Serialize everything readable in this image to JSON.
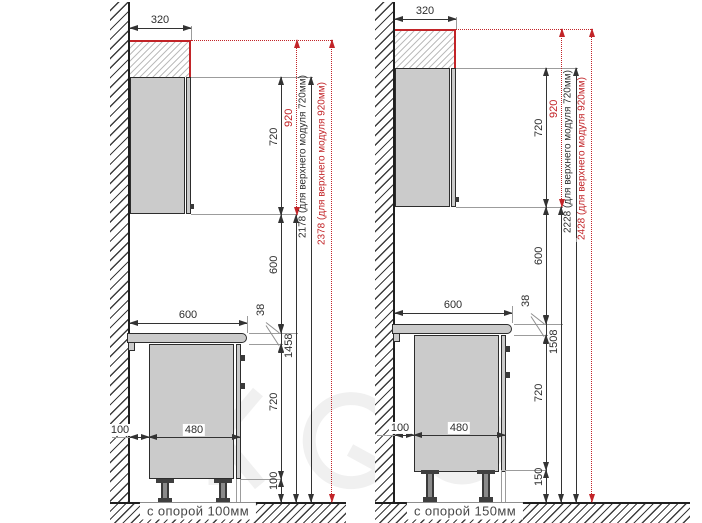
{
  "diagrams": [
    {
      "caption": "с опорой 100мм",
      "dims": {
        "top_depth": "320",
        "upper_height": "720",
        "upper_height_920": "920",
        "gap": "600",
        "counter_width": "600",
        "counter_thickness": "38",
        "floor_to_upper": "1458",
        "base_height": "720",
        "base_depth": "480",
        "wall_offset": "100",
        "support": "100",
        "total_720": "2178 (для верхнего модуля 720мм)",
        "total_920": "2378 (для верхнего модуля 920мм)"
      }
    },
    {
      "caption": "с опорой 150мм",
      "dims": {
        "top_depth": "320",
        "upper_height": "720",
        "upper_height_920": "920",
        "gap": "600",
        "counter_width": "600",
        "counter_thickness": "38",
        "floor_to_upper": "1508",
        "base_height": "720",
        "base_depth": "480",
        "wall_offset": "100",
        "support": "150",
        "total_720": "2228 (для верхнего модуля 720мм)",
        "total_920": "2428 (для верхнего модуля 920мм)"
      }
    }
  ],
  "colors": {
    "accent_red": "#c22428",
    "dimension_line": "#333333",
    "cabinet_fill": "#cbcbcb",
    "structure_line": "#1f1f1f"
  }
}
